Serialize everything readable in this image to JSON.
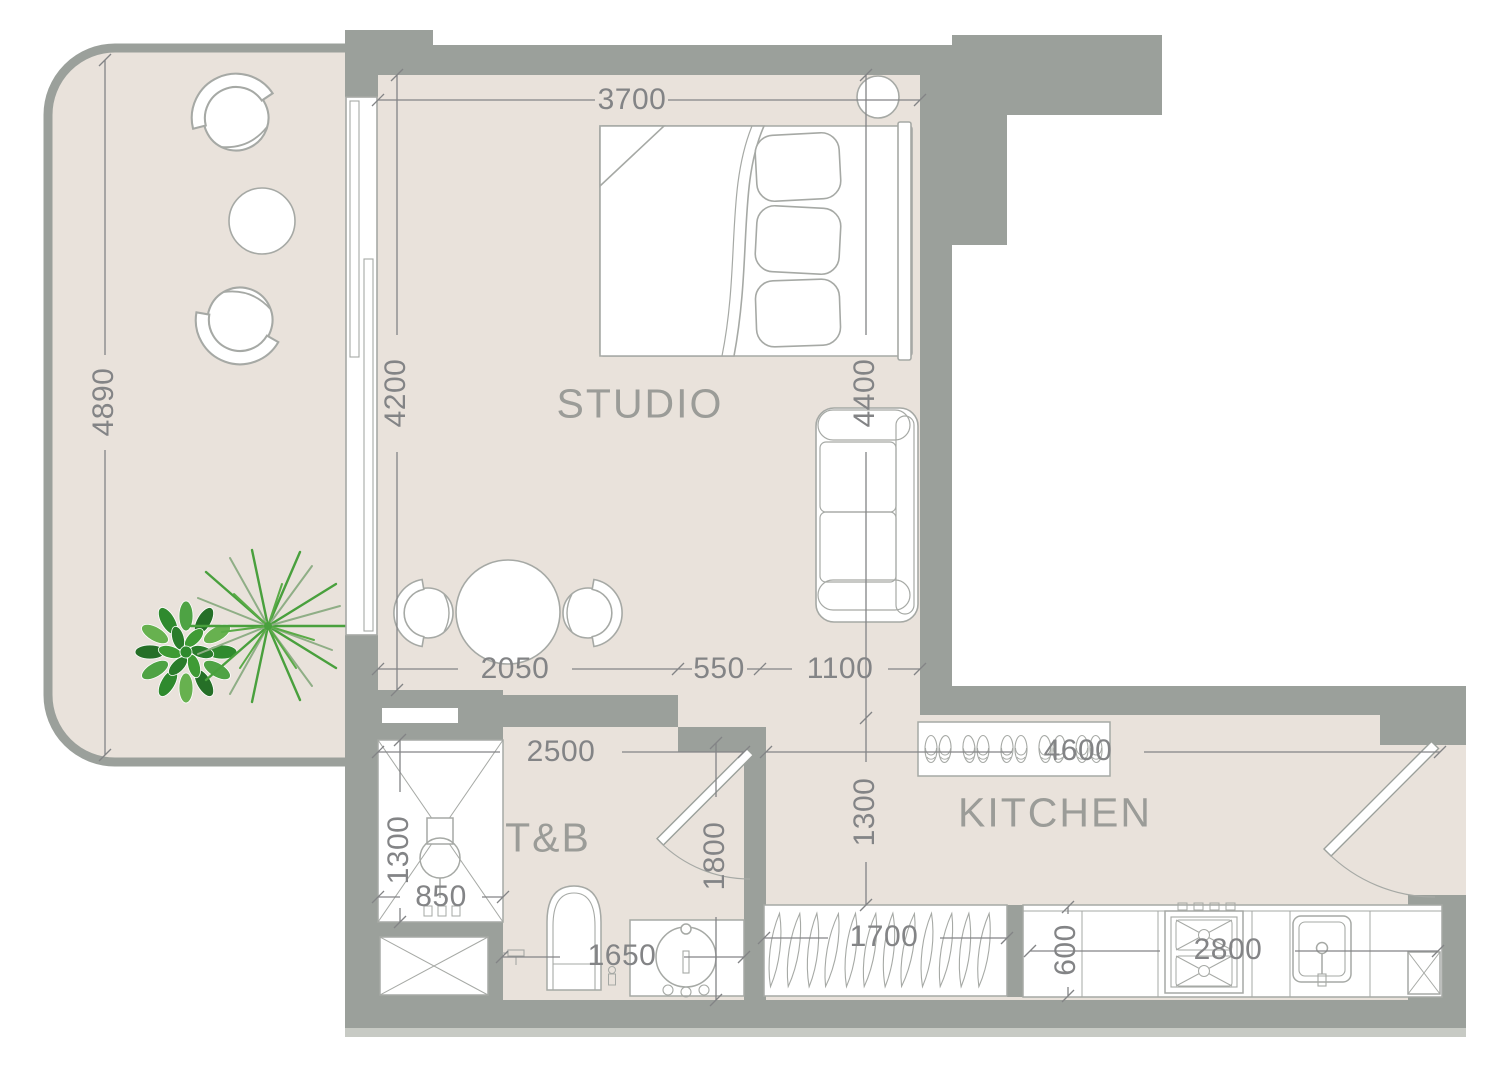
{
  "rooms": {
    "studio": {
      "label": "STUDIO"
    },
    "toilet_bath": {
      "label": "T&B"
    },
    "kitchen": {
      "label": "KITCHEN"
    }
  },
  "dims": {
    "balcony_length": "4890",
    "studio_width": "3700",
    "studio_length": "4200",
    "studio_right_length": "4400",
    "studio_seg_a": "2050",
    "studio_seg_b": "550",
    "studio_seg_c": "1100",
    "tb_width": "2500",
    "shower_length": "1300",
    "shower_width": "850",
    "tb_seg": "1650",
    "tb_length": "1800",
    "kitchen_entry_depth": "1300",
    "kitchen_width": "4600",
    "wardrobe_width": "1700",
    "counter_depth": "600",
    "counter_width": "2800"
  },
  "colors": {
    "wall": "#9ba09b",
    "floor": "#e9e2db",
    "furniture_line": "#a6a9a5",
    "dim_text": "#838486",
    "room_text": "#9b9c98",
    "plant_dark": "#2f8a2e",
    "plant_light": "#5aab47"
  }
}
